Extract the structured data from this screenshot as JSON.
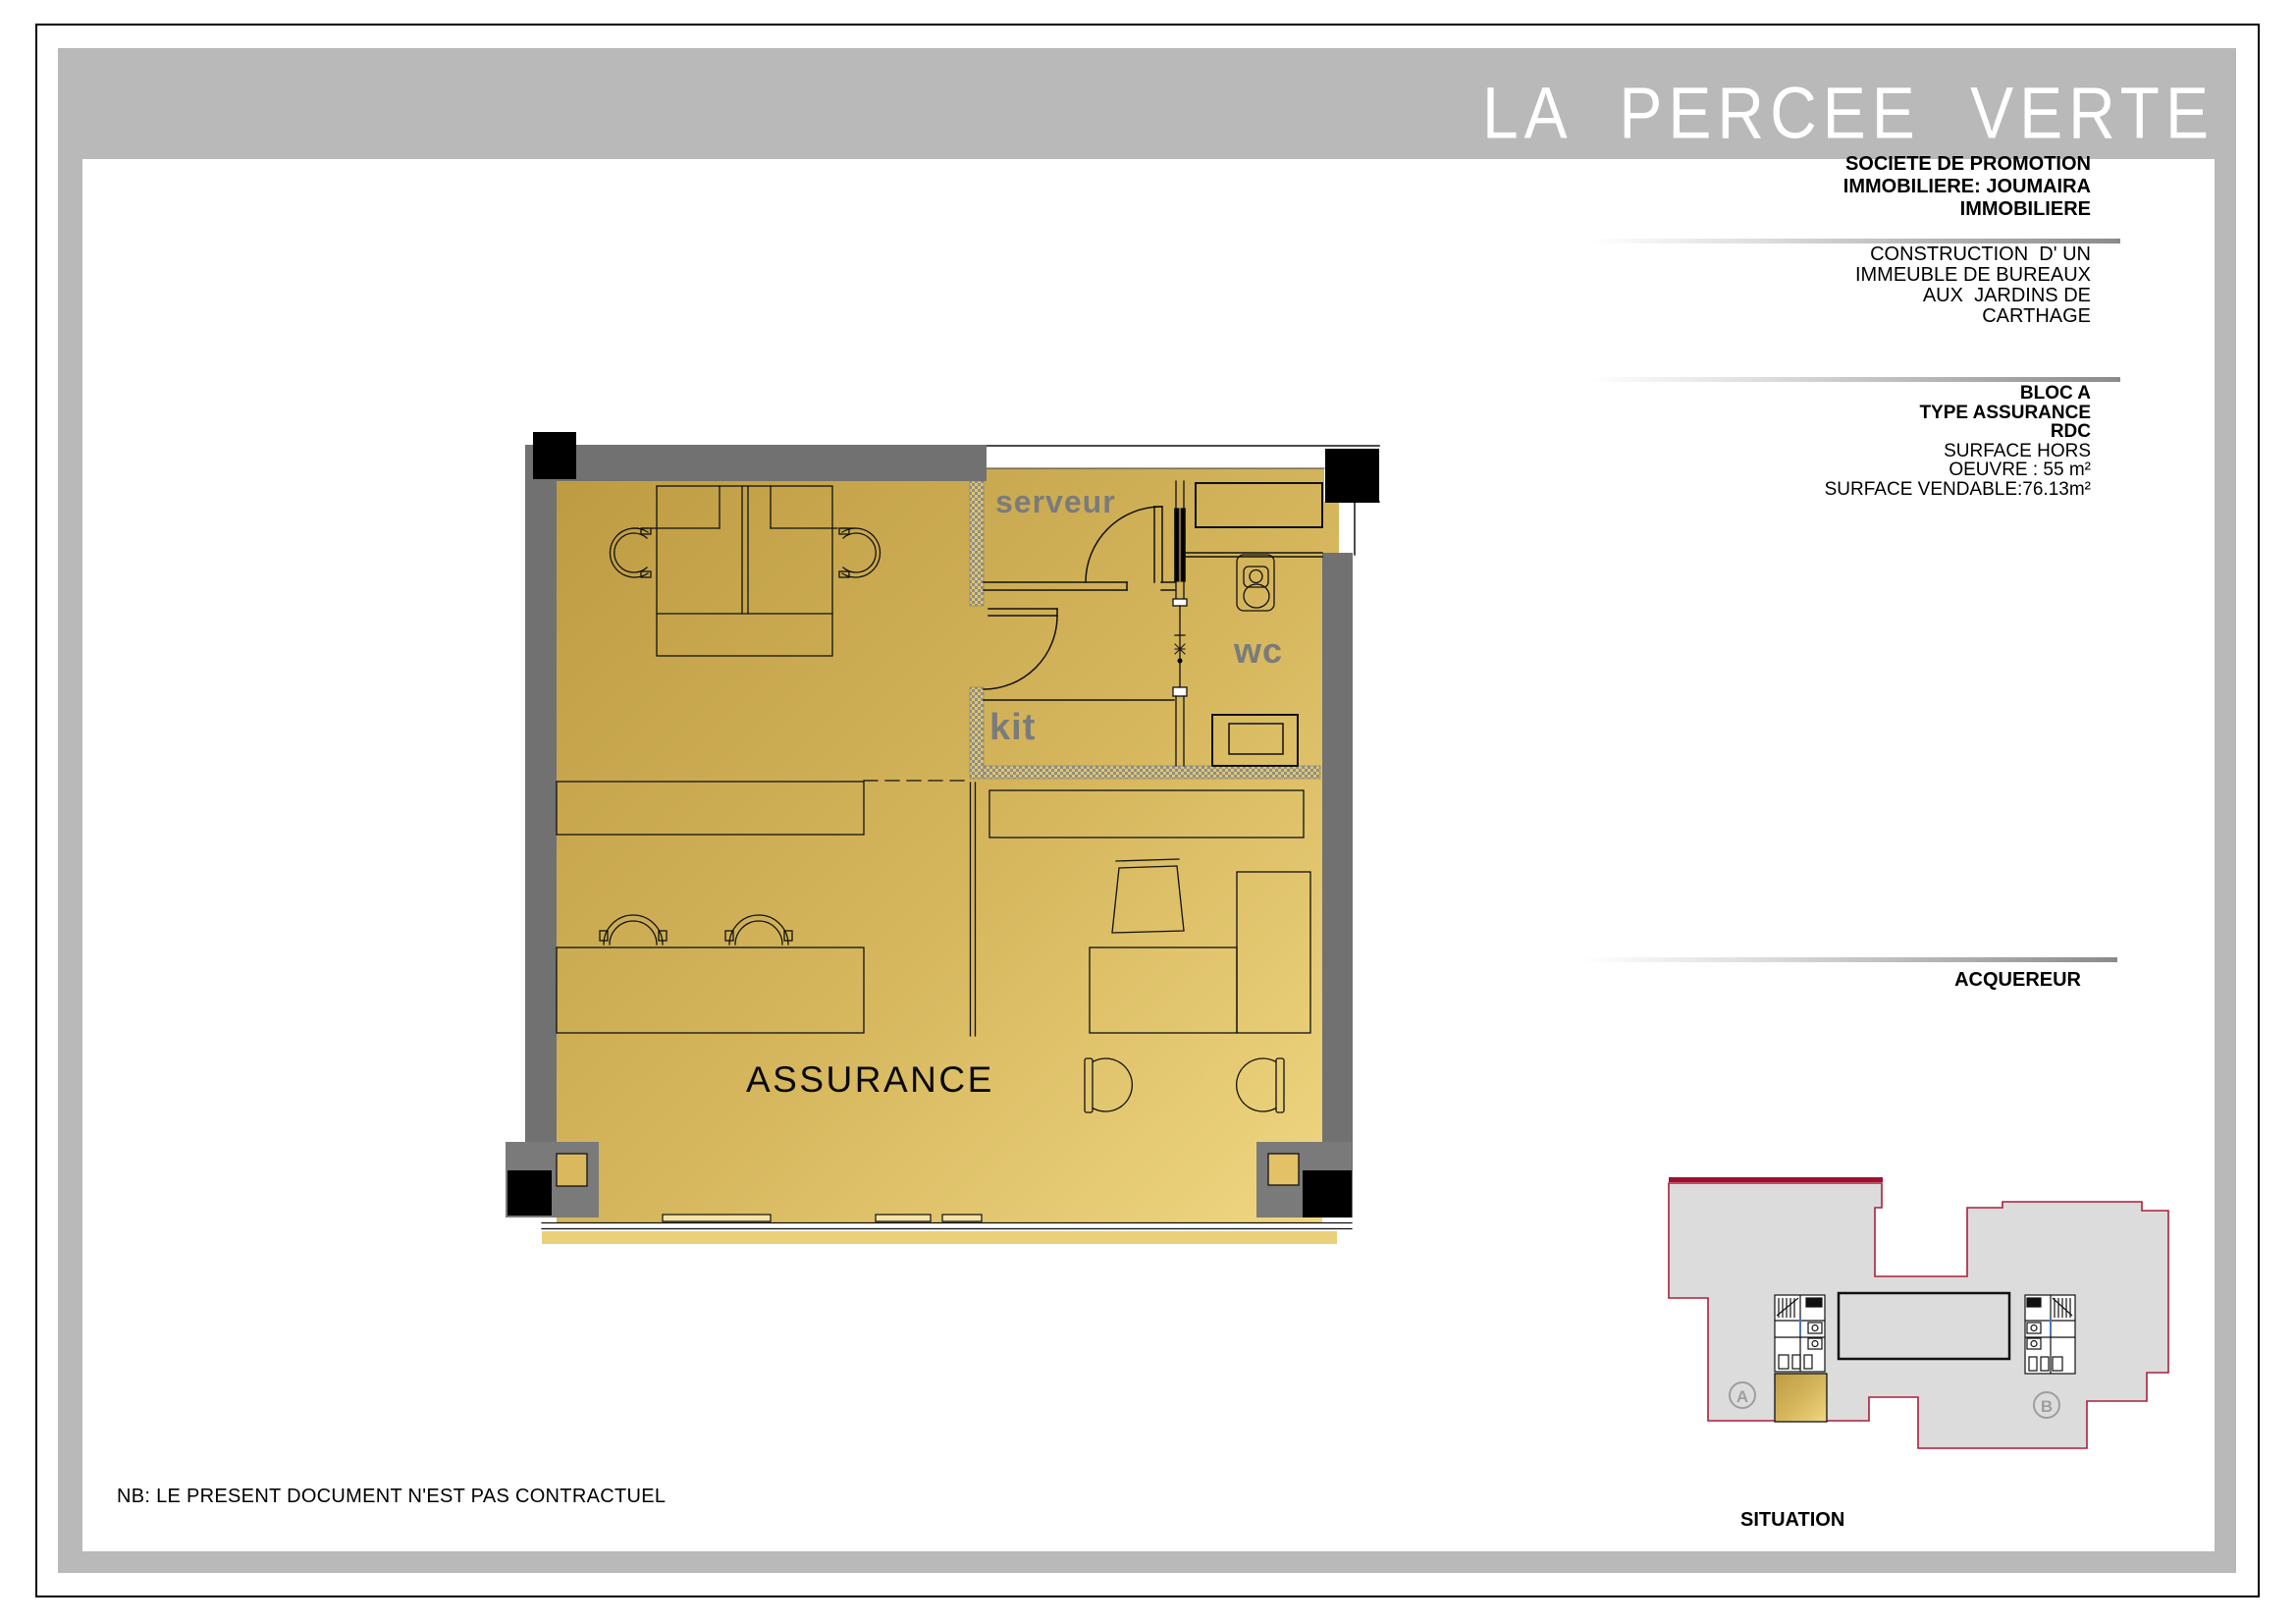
{
  "header": {
    "title": "LA PERCEE VERTE"
  },
  "promoter": {
    "line1": "SOCIETE DE PROMOTION",
    "line2": "IMMOBILIERE: JOUMAIRA",
    "line3": "IMMOBILIERE"
  },
  "project": {
    "line1": "CONSTRUCTION  D' UN",
    "line2": "IMMEUBLE DE BUREAUX",
    "line3": "AUX  JARDINS DE",
    "line4": "CARTHAGE"
  },
  "unit": {
    "bloc": "BLOC A",
    "type": "TYPE ASSURANCE",
    "level": "RDC",
    "surface_line1": "SURFACE HORS",
    "surface_line2": "OEUVRE : 55 m²",
    "surface_line3": "SURFACE VENDABLE:76.13m²"
  },
  "acquirer": {
    "label": "ACQUEREUR"
  },
  "plan": {
    "room_main": "ASSURANCE",
    "room_serveur": "serveur",
    "room_wc": "wc",
    "room_kit": "kit"
  },
  "situation": {
    "caption": "SITUATION",
    "block_a_label": "A",
    "block_b_label": "B"
  },
  "footer": {
    "note": "NB: LE PRESENT DOCUMENT N'EST PAS CONTRACTUEL"
  },
  "colors": {
    "frame_grey": "#b9b9b9",
    "wall_grey": "#717171",
    "floor_gold_dark": "#c09e45",
    "floor_gold_light": "#f0d782",
    "label_grey": "#7b7b7b",
    "site_outline_red": "#ab1f3c",
    "site_fill_grey": "#dcdcdc"
  }
}
